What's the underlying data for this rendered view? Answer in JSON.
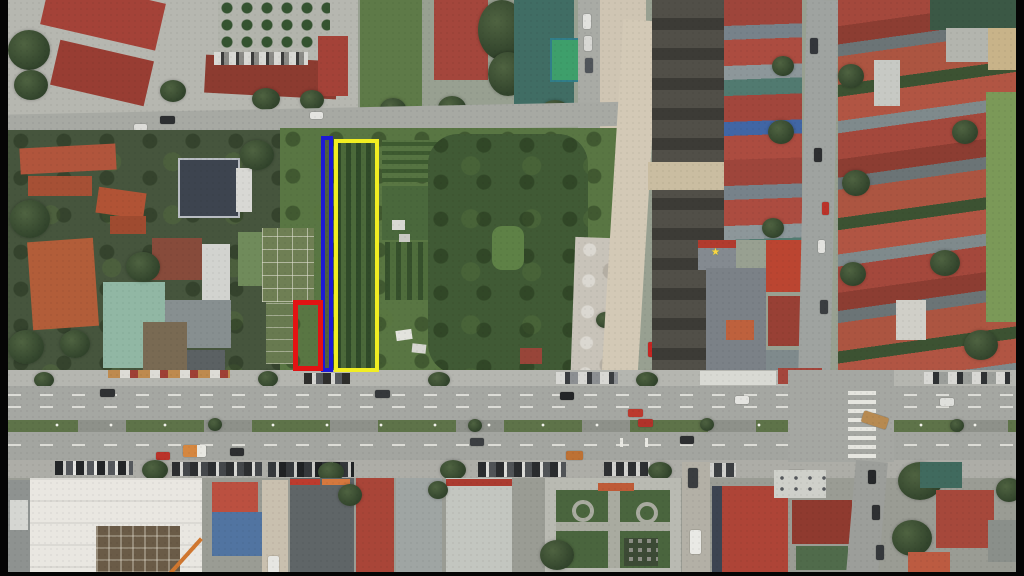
{
  "annotations": {
    "yellow_plot": {
      "color": "#f2ee18",
      "x": 334,
      "y": 139,
      "width": 45,
      "height": 233,
      "stroke": 4
    },
    "blue_plot": {
      "color": "#1c18dd",
      "x": 321,
      "y": 136,
      "width": 12,
      "height": 236,
      "stroke": 4
    },
    "red_plot": {
      "color": "#eb1111",
      "x": 293,
      "y": 300,
      "width": 30,
      "height": 71,
      "stroke": 5
    }
  },
  "frame": {
    "bar_color": "#050505"
  },
  "icons": {
    "flag_star": "★"
  },
  "palette": {
    "asphalt": "#a5a7a2",
    "dirt_road": "#d3c9b5",
    "field_green": "#587741",
    "roof_red": "#a8473a",
    "gravel_lot": "#c8c3b8"
  }
}
